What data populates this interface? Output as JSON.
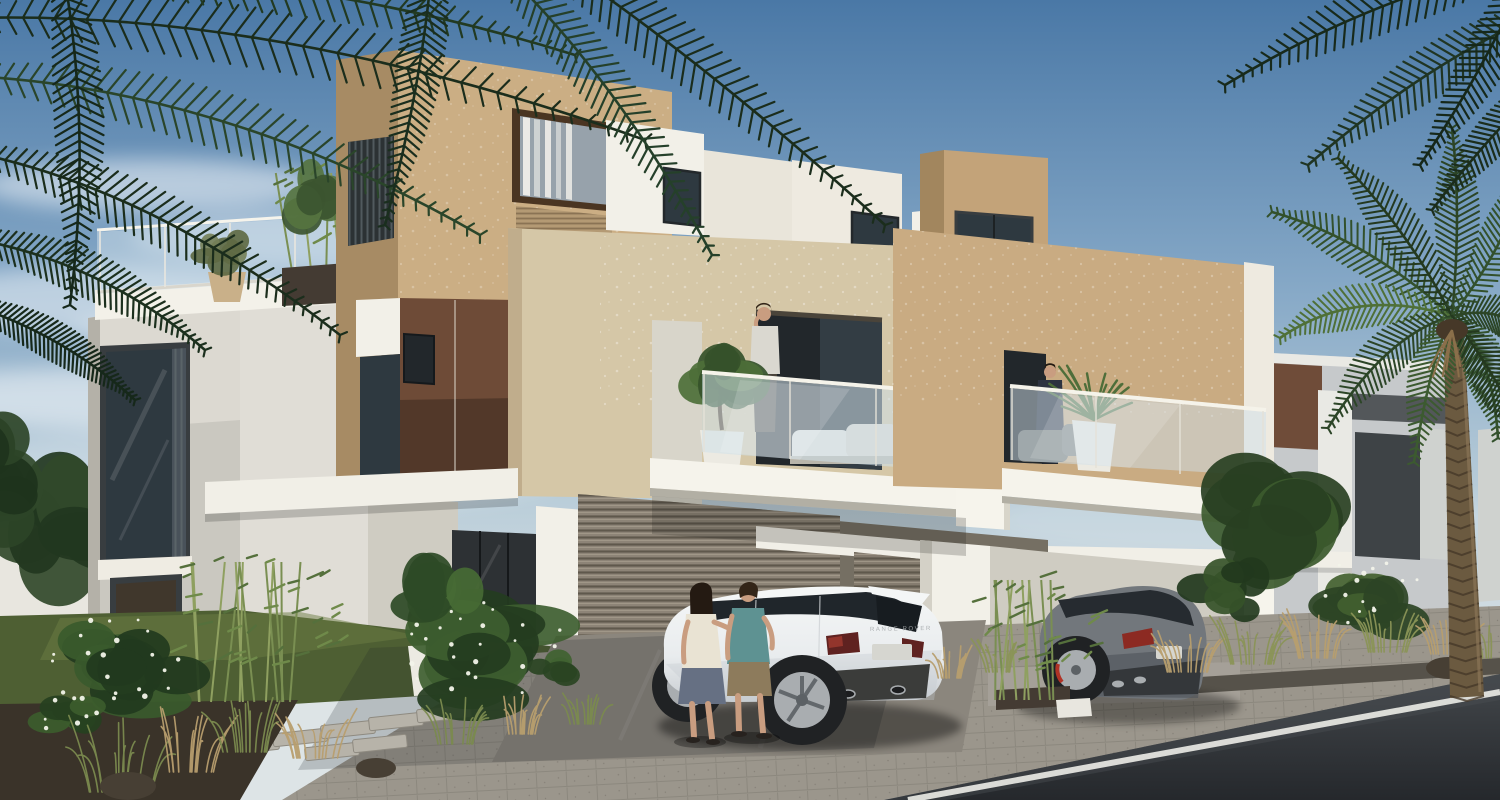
{
  "meta": {
    "title": "Architectural rendering — modern twin villas, street view, daytime",
    "width": 1500,
    "height": 800
  },
  "scene": {
    "setting": "sunny daytime 3D rendering of contemporary flat-roofed villas with roof terrace, balconies, louvered garage, landscaped front yard, paver driveway and asphalt road",
    "vehicle_badge_text": "RANGE ROVER",
    "objects": [
      "sky",
      "clouds",
      "palm-fronds-top-left",
      "palm-fronds-top-right",
      "date-palm-right",
      "neighbor-building-left",
      "neighbor-building-right",
      "main-villa",
      "roof-terrace-glass-railing",
      "terrace-plants",
      "tan-upper-block",
      "bronze-clad-block",
      "white-parapet-boxes",
      "beige-second-floor",
      "balcony-left",
      "balcony-right",
      "white-fin-wall",
      "balcony-glass-railings",
      "balcony-planters",
      "lounge-chairs",
      "louvered-garage-doors",
      "entry-glazing",
      "porch-pillar",
      "canopy-slabs",
      "front-garden",
      "plumeria-shrubs",
      "bamboo-plants",
      "ornamental-grasses",
      "lawn",
      "stepping-stones",
      "rocks",
      "paver-driveway",
      "asphalt-road",
      "road-marking-line",
      "white-range-rover-evoque",
      "gray-suv",
      "standing-couple",
      "balcony-man-phone",
      "balcony-man-suit",
      "wheel-stop"
    ],
    "people": [
      {
        "name": "woman-standing",
        "detail": "long dark hair, cream top, gray skirt"
      },
      {
        "name": "man-standing",
        "detail": "teal t-shirt, khaki shorts"
      },
      {
        "name": "man-balcony-left",
        "detail": "light t-shirt, phone to ear"
      },
      {
        "name": "man-balcony-right",
        "detail": "dark suit"
      }
    ],
    "palette": {
      "wall_white": "#dcd9d1",
      "wall_shade": "#b4b1a8",
      "parapet_white": "#f3f1e9",
      "tan_front": "#cbae84",
      "tan_side": "#a78b64",
      "tan_cube": "#c3a379",
      "tan_cube_side": "#a2865e",
      "tan_right": "#c9ab82",
      "stucco": "#d5c7a7",
      "stucco_edge": "#c0ad8c",
      "white_box": "#f2f0e8",
      "white_box2": "#eeeae0",
      "cream_box": "#e9e5da",
      "brown_clad": "#6e4b37",
      "window_brown": "#4a3522",
      "glass_dark": "#2e3940",
      "glass_deep": "#22272b",
      "glass_sky": "#97a2ab",
      "glass_warm": "#40372c",
      "frame_dark": "#383d40",
      "sill_white": "#efece3",
      "slat_dark": "#2c3234",
      "balc_glass": "#cfe0ea",
      "rail_white": "#f5f3eb",
      "fin_white": "#f6f4ec",
      "fin_shade": "#d8d5ca",
      "slab_white": "#f1efe7",
      "louver_base": "#8d8477",
      "louver_base2": "#857c6f",
      "recess": "#756f63",
      "porch_white": "#f2f0e8",
      "wall_right": "#cfccc2",
      "entry_glass": "#2d3134",
      "bg_building": "#c6c9cb",
      "bg_brown": "#6f4c39",
      "bg_band": "#53575a",
      "bg_col": "#e9e9e4",
      "bg_window": "#3e4346",
      "bg_far": "#cfd2cf",
      "bg_wall_left": "#e8e6df",
      "lawn": "#4e5f33",
      "lawn_dark": "#46552f",
      "lawn_light": "#6b7d44",
      "soil": "#3a3329",
      "rock": "#473f34",
      "grass_tan": "#b79e6e",
      "stone": "#b7b3a9",
      "paver": "#9b968c",
      "apron": "#8b867d",
      "walk": "#a5a098",
      "gutter": "#56524a",
      "road": "#383c40",
      "road_deep": "#2b2f33",
      "lane": "#e9e9e4",
      "wheelstop": "#e8e6df",
      "leaf_dark": "#24391f",
      "leaf_mid": "#3a5a2e",
      "leaf_light": "#5d7c3f",
      "olive": "#6f7450",
      "palm_dark": "#1b2d1c",
      "palm_mid": "#33512c",
      "palm_light": "#4f7038",
      "trunk": "#6b5a40",
      "trunk_dark": "#463828",
      "trunk_light": "#8a7557",
      "planter_dark": "#443b33",
      "pot_white": "#eceae2",
      "pot_tan": "#c9b089",
      "car_white": "#edeff0",
      "car_bright": "#f4f6f6",
      "car_shade": "#c3c9cd",
      "car_glass": "#20262b",
      "tail_red": "#5f2220",
      "tail_accent": "#93352c",
      "plate": "#d6d6d0",
      "tire": "#202224",
      "alloy": "#a9adb0",
      "bumper_dark": "#3b3c3a",
      "suv_gray": "#72777c",
      "suv_glass": "#262b30",
      "suv_shade": "#4e545a",
      "suv_red": "#8c2a22",
      "suv_bumper": "#34373a",
      "caliper": "#b03326",
      "skin": "#c99d80",
      "hair_dark": "#241a12",
      "hair_brown": "#332518",
      "cream_top": "#e9e3d3",
      "skirt_gray": "#667083",
      "teal_shirt": "#5e9292",
      "khaki_shorts": "#8d7b5c",
      "shoe_dark": "#27221e",
      "shirt_light": "#dad8d0",
      "pants_dark": "#4a443c",
      "suit_dark": "#2d3340",
      "suit_legs": "#23272e"
    }
  }
}
